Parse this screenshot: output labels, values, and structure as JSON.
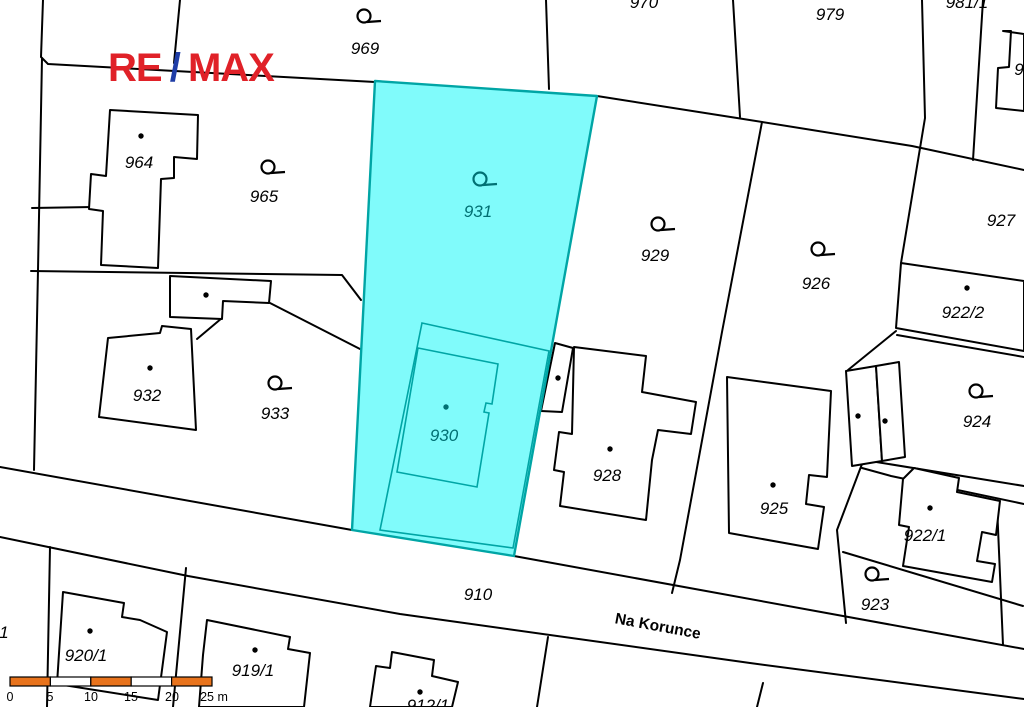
{
  "map": {
    "colors": {
      "background": "#ffffff",
      "boundary": "#000000",
      "building_fill": "#ffffff",
      "highlight_fill": "#80fbfb",
      "highlight_border": "#00a5a5",
      "highlight_text": "#007073",
      "label_text": "#000000"
    },
    "street_label": {
      "text": "Na Korunce",
      "x": 657,
      "y": 631,
      "angle": 10.5
    },
    "parcel_labels": [
      {
        "text": "969",
        "x": 365,
        "y": 54
      },
      {
        "text": "970",
        "x": 644,
        "y": 8,
        "partial": "top"
      },
      {
        "text": "979",
        "x": 830,
        "y": 20
      },
      {
        "text": "981/1",
        "x": 967,
        "y": 8,
        "partial": "top"
      },
      {
        "text": "9",
        "x": 1019,
        "y": 75,
        "partial": "right"
      },
      {
        "text": "927",
        "x": 1001,
        "y": 226
      },
      {
        "text": "964",
        "x": 139,
        "y": 168
      },
      {
        "text": "965",
        "x": 264,
        "y": 202
      },
      {
        "text": "929",
        "x": 655,
        "y": 261
      },
      {
        "text": "926",
        "x": 816,
        "y": 289
      },
      {
        "text": "922/2",
        "x": 963,
        "y": 318
      },
      {
        "text": "932",
        "x": 147,
        "y": 401
      },
      {
        "text": "933",
        "x": 275,
        "y": 419
      },
      {
        "text": "931",
        "x": 478,
        "y": 217,
        "highlight": true
      },
      {
        "text": "930",
        "x": 444,
        "y": 441,
        "highlight": true
      },
      {
        "text": "924",
        "x": 977,
        "y": 427
      },
      {
        "text": "928",
        "x": 607,
        "y": 481
      },
      {
        "text": "925",
        "x": 774,
        "y": 514
      },
      {
        "text": "922/1",
        "x": 925,
        "y": 541
      },
      {
        "text": "923",
        "x": 875,
        "y": 610
      },
      {
        "text": "910",
        "x": 478,
        "y": 600
      },
      {
        "text": "920/1",
        "x": 86,
        "y": 661
      },
      {
        "text": "919/1",
        "x": 253,
        "y": 676
      },
      {
        "text": "912/1",
        "x": 428,
        "y": 711,
        "partial": "bottom"
      },
      {
        "text": "1",
        "x": 4,
        "y": 638,
        "partial": "left"
      }
    ],
    "land_use_symbols": [
      {
        "x": 364,
        "y": 16
      },
      {
        "x": 268,
        "y": 167
      },
      {
        "x": 480,
        "y": 179,
        "highlight": true
      },
      {
        "x": 658,
        "y": 224
      },
      {
        "x": 818,
        "y": 249
      },
      {
        "x": 275,
        "y": 383
      },
      {
        "x": 976,
        "y": 391
      },
      {
        "x": 872,
        "y": 574
      }
    ],
    "building_dots": [
      {
        "x": 141,
        "y": 136
      },
      {
        "x": 206,
        "y": 295
      },
      {
        "x": 150,
        "y": 368
      },
      {
        "x": 558,
        "y": 378
      },
      {
        "x": 446,
        "y": 407,
        "highlight": true
      },
      {
        "x": 610,
        "y": 449
      },
      {
        "x": 773,
        "y": 485
      },
      {
        "x": 967,
        "y": 288
      },
      {
        "x": 858,
        "y": 416
      },
      {
        "x": 885,
        "y": 421
      },
      {
        "x": 930,
        "y": 508
      },
      {
        "x": 90,
        "y": 631
      },
      {
        "x": 255,
        "y": 650
      },
      {
        "x": 420,
        "y": 692
      }
    ]
  },
  "logo": {
    "re": "RE",
    "slash": "/",
    "max": "MAX",
    "red": "#e02128",
    "blue": "#1f3da6"
  },
  "scalebar": {
    "unit_labels": [
      "0",
      "5",
      "10",
      "15",
      "20",
      "25 m"
    ],
    "bar_color": "#e8731c",
    "alt_color": "#ffffff",
    "border_color": "#000000"
  }
}
